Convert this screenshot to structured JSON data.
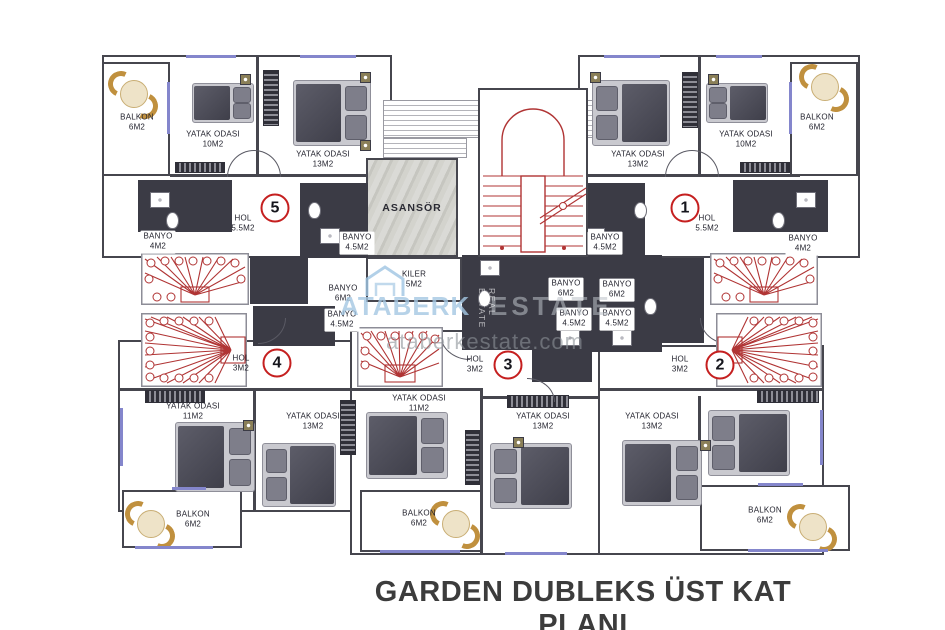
{
  "title": "GARDEN DUBLEKS ÜST KAT PLANI",
  "watermark": {
    "brand_left": "ATABERK",
    "brand_right": "ESTATE",
    "url": "ataberkestate.com",
    "vertical_text": "REAL ESTATE"
  },
  "common": {
    "asansor": {
      "label": "ASANSÖR"
    },
    "kiler": {
      "label": "KILER",
      "area": "5M2"
    }
  },
  "units": {
    "u1": {
      "number": "1"
    },
    "u2": {
      "number": "2"
    },
    "u3": {
      "number": "3"
    },
    "u4": {
      "number": "4"
    },
    "u5": {
      "number": "5"
    }
  },
  "rooms": {
    "u5_balkon": {
      "label": "BALKON",
      "area": "6M2"
    },
    "u5_bed10": {
      "label": "YATAK ODASI",
      "area": "10M2"
    },
    "u5_bed13": {
      "label": "YATAK ODASI",
      "area": "13M2"
    },
    "u5_hol": {
      "label": "HOL",
      "area": "5.5M2"
    },
    "u5_banyo4": {
      "label": "BANYO",
      "area": "4M2"
    },
    "u5_banyo45": {
      "label": "BANYO",
      "area": "4.5M2"
    },
    "u1_balkon": {
      "label": "BALKON",
      "area": "6M2"
    },
    "u1_bed10": {
      "label": "YATAK ODASI",
      "area": "10M2"
    },
    "u1_bed13": {
      "label": "YATAK ODASI",
      "area": "13M2"
    },
    "u1_hol": {
      "label": "HOL",
      "area": "5.5M2"
    },
    "u1_banyo4": {
      "label": "BANYO",
      "area": "4M2"
    },
    "u1_banyo45": {
      "label": "BANYO",
      "area": "4.5M2"
    },
    "u4_hol": {
      "label": "HOL",
      "area": "3M2"
    },
    "u4_banyo6": {
      "label": "BANYO",
      "area": "6M2"
    },
    "u4_banyo45": {
      "label": "BANYO",
      "area": "4.5M2"
    },
    "u4_bed11": {
      "label": "YATAK ODASI",
      "area": "11M2"
    },
    "u4_bed13": {
      "label": "YATAK ODASI",
      "area": "13M2"
    },
    "u4_balkon": {
      "label": "BALKON",
      "area": "6M2"
    },
    "u3_hol": {
      "label": "HOL",
      "area": "3M2"
    },
    "u3_banyo6": {
      "label": "BANYO",
      "area": "6M2"
    },
    "u3_banyo45": {
      "label": "BANYO",
      "area": "4.5M2"
    },
    "u3_bed11": {
      "label": "YATAK ODASI",
      "area": "11M2"
    },
    "u3_bed13": {
      "label": "YATAK ODASI",
      "area": "13M2"
    },
    "u3_balkon": {
      "label": "BALKON",
      "area": "6M2"
    },
    "u2_hol": {
      "label": "HOL",
      "area": "3M2"
    },
    "u2_banyo6": {
      "label": "BANYO",
      "area": "6M2"
    },
    "u2_banyo45": {
      "label": "BANYO",
      "area": "4.5M2"
    },
    "u2_bed13": {
      "label": "YATAK ODASI",
      "area": "13M2"
    },
    "u2_balkon": {
      "label": "BALKON",
      "area": "6M2"
    }
  },
  "colors": {
    "wall": "#3b3b45",
    "stair_red": "#b03434",
    "window": "#8486cc",
    "unit_circle": "#c51f1f",
    "watermark_blue": "#a5c8e3",
    "furniture_gold": "#c0903e"
  }
}
